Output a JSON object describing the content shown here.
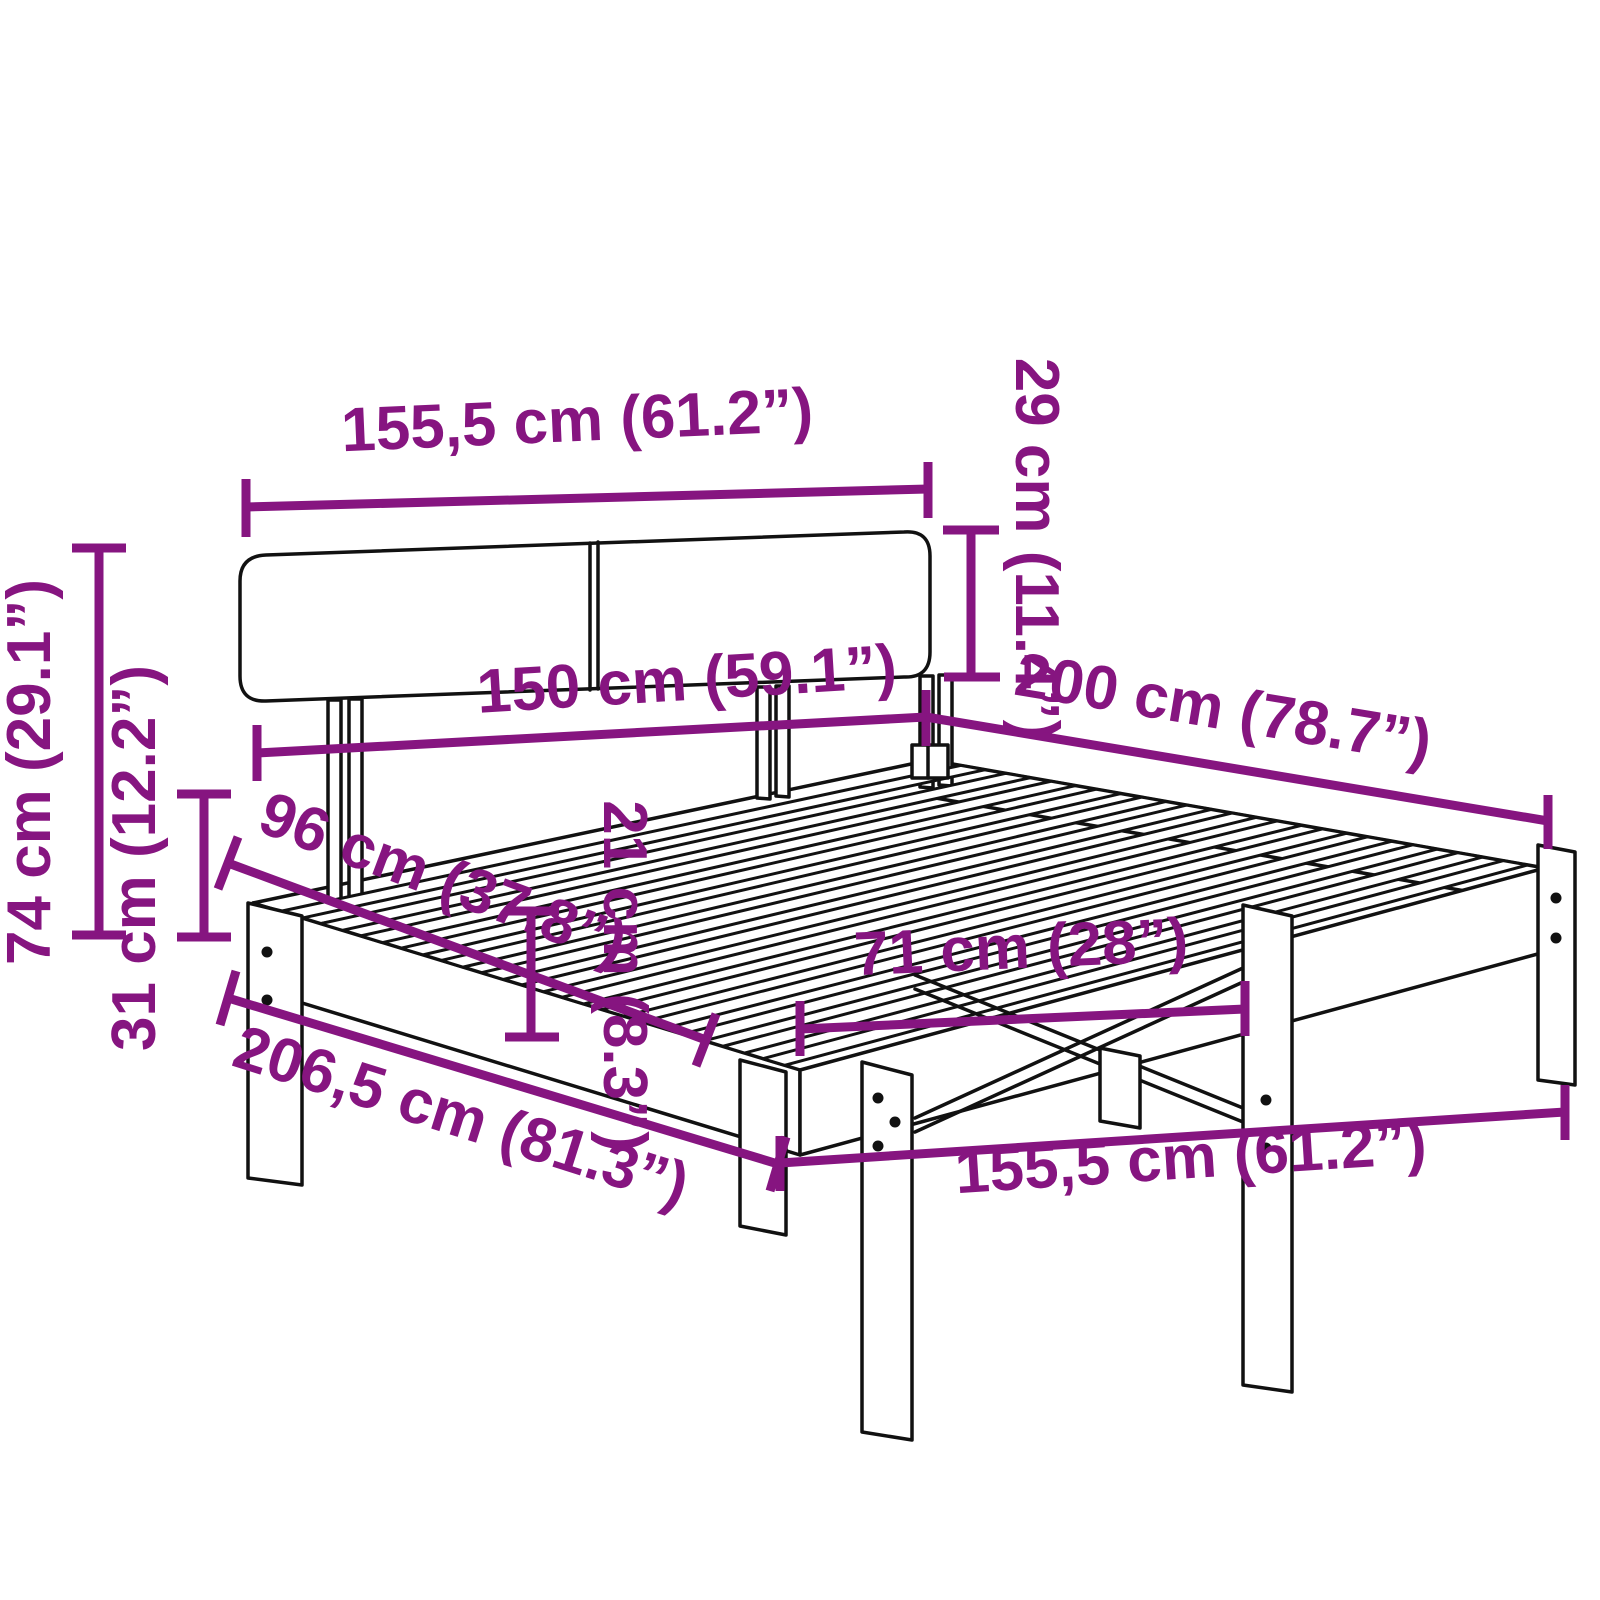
{
  "diagram": {
    "title": "bed-frame-dimension-diagram",
    "product": "bed frame with headboard and slatted base",
    "background": "#ffffff",
    "colors": {
      "dimension_accent": "#861580",
      "outline": "#111111"
    },
    "units": [
      "cm",
      "inch"
    ],
    "dimensions": [
      {
        "id": "headboard-width",
        "label": "155,5 cm (61.2”)",
        "cm": "155,5",
        "inch": "61.2"
      },
      {
        "id": "headboard-height",
        "label": "29 cm (11.4”)",
        "cm": "29",
        "inch": "11.4"
      },
      {
        "id": "inner-width",
        "label": "150 cm (59.1”)",
        "cm": "150",
        "inch": "59.1"
      },
      {
        "id": "inner-length",
        "label": "200 cm (78.7”)",
        "cm": "200",
        "inch": "78.7"
      },
      {
        "id": "total-height",
        "label": "74 cm (29.1”)",
        "cm": "74",
        "inch": "29.1"
      },
      {
        "id": "base-height",
        "label": "31 cm (12.2”)",
        "cm": "31",
        "inch": "12.2"
      },
      {
        "id": "floor-to-headboard-top",
        "label": "96 cm (37.8”)",
        "cm": "96",
        "inch": "37.8"
      },
      {
        "id": "frame-side-height",
        "label": "21 cm (8.3”)",
        "cm": "21",
        "inch": "8.3"
      },
      {
        "id": "leg-spacing",
        "label": "71 cm (28”)",
        "cm": "71",
        "inch": "28"
      },
      {
        "id": "total-length",
        "label": "206,5 cm (81.3”)",
        "cm": "206,5",
        "inch": "81.3"
      },
      {
        "id": "total-width",
        "label": "155,5 cm (61.2”)",
        "cm": "155,5",
        "inch": "61.2"
      }
    ]
  }
}
